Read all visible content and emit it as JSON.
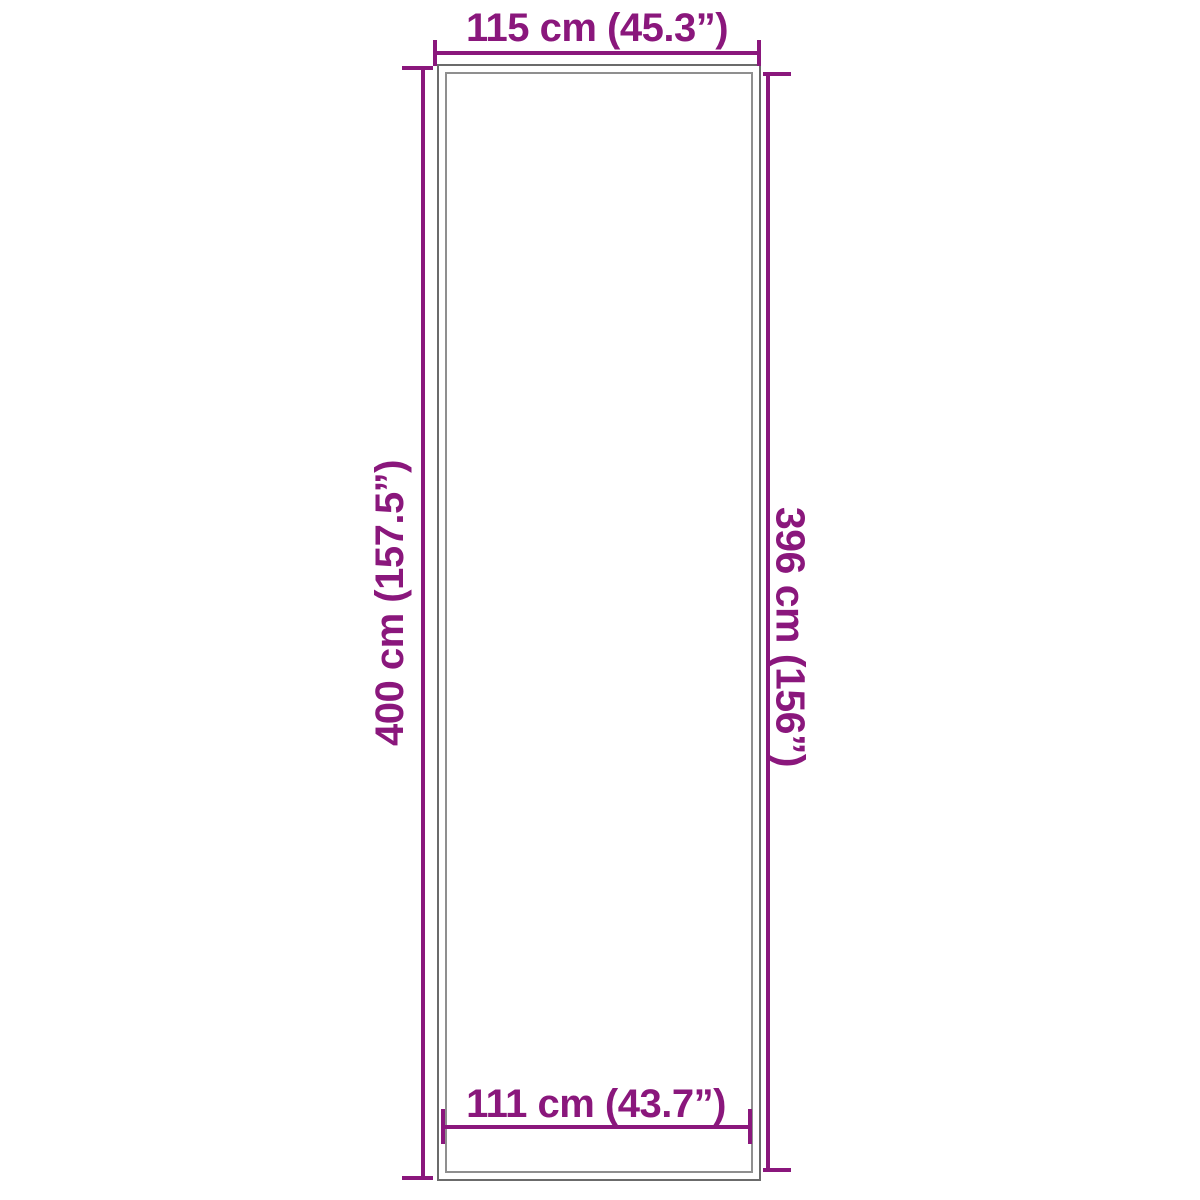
{
  "colors": {
    "dimension_accent": "#8a177c",
    "outline_outer": "#6b6b6b",
    "outline_inner": "#8f8f8f",
    "background": "#ffffff"
  },
  "dimensions": {
    "top_width": {
      "label": "115 cm (45.3”)",
      "value_cm": 115,
      "value_inches": 45.3
    },
    "bottom_width": {
      "label": "111 cm (43.7”)",
      "value_cm": 111,
      "value_inches": 43.7
    },
    "left_height": {
      "label": "400 cm (157.5”)",
      "value_cm": 400,
      "value_inches": 157.5
    },
    "right_height": {
      "label": "396 cm (156”)",
      "value_cm": 396,
      "value_inches": 156
    }
  }
}
